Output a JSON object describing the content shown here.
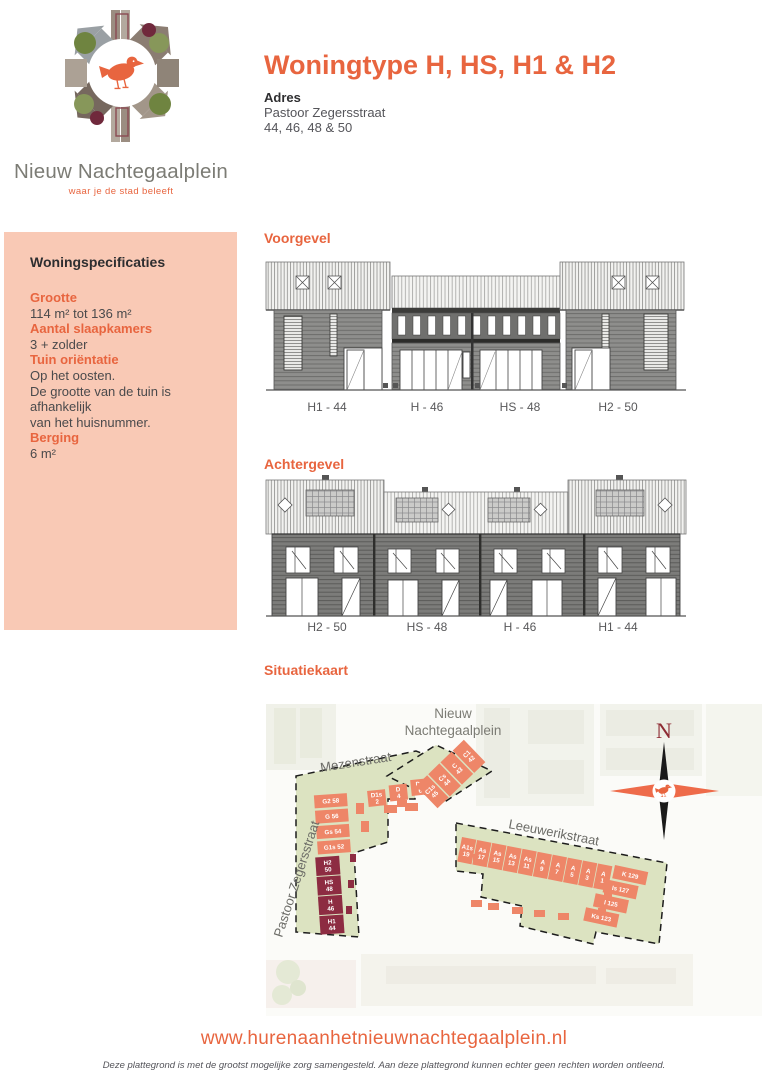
{
  "colors": {
    "accent": "#e8653f",
    "sidebar_bg": "#f9c9b5",
    "text_dark": "#2e2e30",
    "text_gray": "#55555a",
    "logo_gray": "#7c7c75",
    "map_orange": "#ee8668",
    "map_maroon": "#8d2c42",
    "map_green": "#dce3c1",
    "compass_black": "#1a1a1a"
  },
  "logo": {
    "title": "Nieuw Nachtegaalplein",
    "tagline": "waar je de stad beleeft"
  },
  "header": {
    "title": "Woningtype H, HS, H1 & H2",
    "address_label": "Adres",
    "address_street": "Pastoor Zegersstraat",
    "address_numbers": "44, 46, 48 & 50"
  },
  "specs": {
    "heading": "Woningspecificaties",
    "items": [
      {
        "label": "Grootte",
        "lines": [
          "114 m² tot 136 m²"
        ]
      },
      {
        "label": "Aantal slaapkamers",
        "lines": [
          "3 + zolder"
        ]
      },
      {
        "label": "Tuin oriëntatie",
        "lines": [
          "Op het oosten.",
          "De grootte van de tuin is afhankelijk",
          "van het huisnummer."
        ]
      },
      {
        "label": "Berging",
        "lines": [
          "6 m²"
        ]
      }
    ]
  },
  "elevations": {
    "front": {
      "title": "Voorgevel",
      "units": [
        "H1 - 44",
        "H - 46",
        "HS - 48",
        "H2 - 50"
      ]
    },
    "rear": {
      "title": "Achtergevel",
      "units": [
        "H2 - 50",
        "HS - 48",
        "H - 46",
        "H1 - 44"
      ]
    }
  },
  "map": {
    "title": "Situatiekaart",
    "place_label": [
      "Nieuw",
      "Nachtegaalplein"
    ],
    "streets": {
      "mezenstraat": "Mezenstraat",
      "pastoor_zegersstraat": "Pastoor Zegersstraat",
      "leeuwerikstraat": "Leeuwerikstraat"
    },
    "compass_label": "N",
    "unit_groups": {
      "g_row": [
        "G2 58",
        "G 56",
        "Gs 54",
        "G1s 52"
      ],
      "h_column_highlighted": [
        "H2 50",
        "HS 48",
        "H 46",
        "H1 44"
      ],
      "d_row": [
        "D1s 2",
        "D 4",
        "D1 6"
      ],
      "c_row": [
        "C1s 45",
        "Cs 44",
        "C 43",
        "C1 42"
      ],
      "a_row": [
        "A1s 19",
        "As 17",
        "As 15",
        "As 13",
        "As 11",
        "A 9",
        "A 7",
        "A 5",
        "A 3",
        "A 1"
      ],
      "k_column": [
        "K 129",
        "Is 127",
        "I 125",
        "Ks 123"
      ]
    }
  },
  "footer": {
    "url": "www.hurenaanhetnieuwnachtegaalplein.nl",
    "disclaimer": "Deze plattegrond is met de grootst mogelijke zorg samengesteld. Aan deze plattegrond kunnen echter geen rechten worden ontleend."
  }
}
